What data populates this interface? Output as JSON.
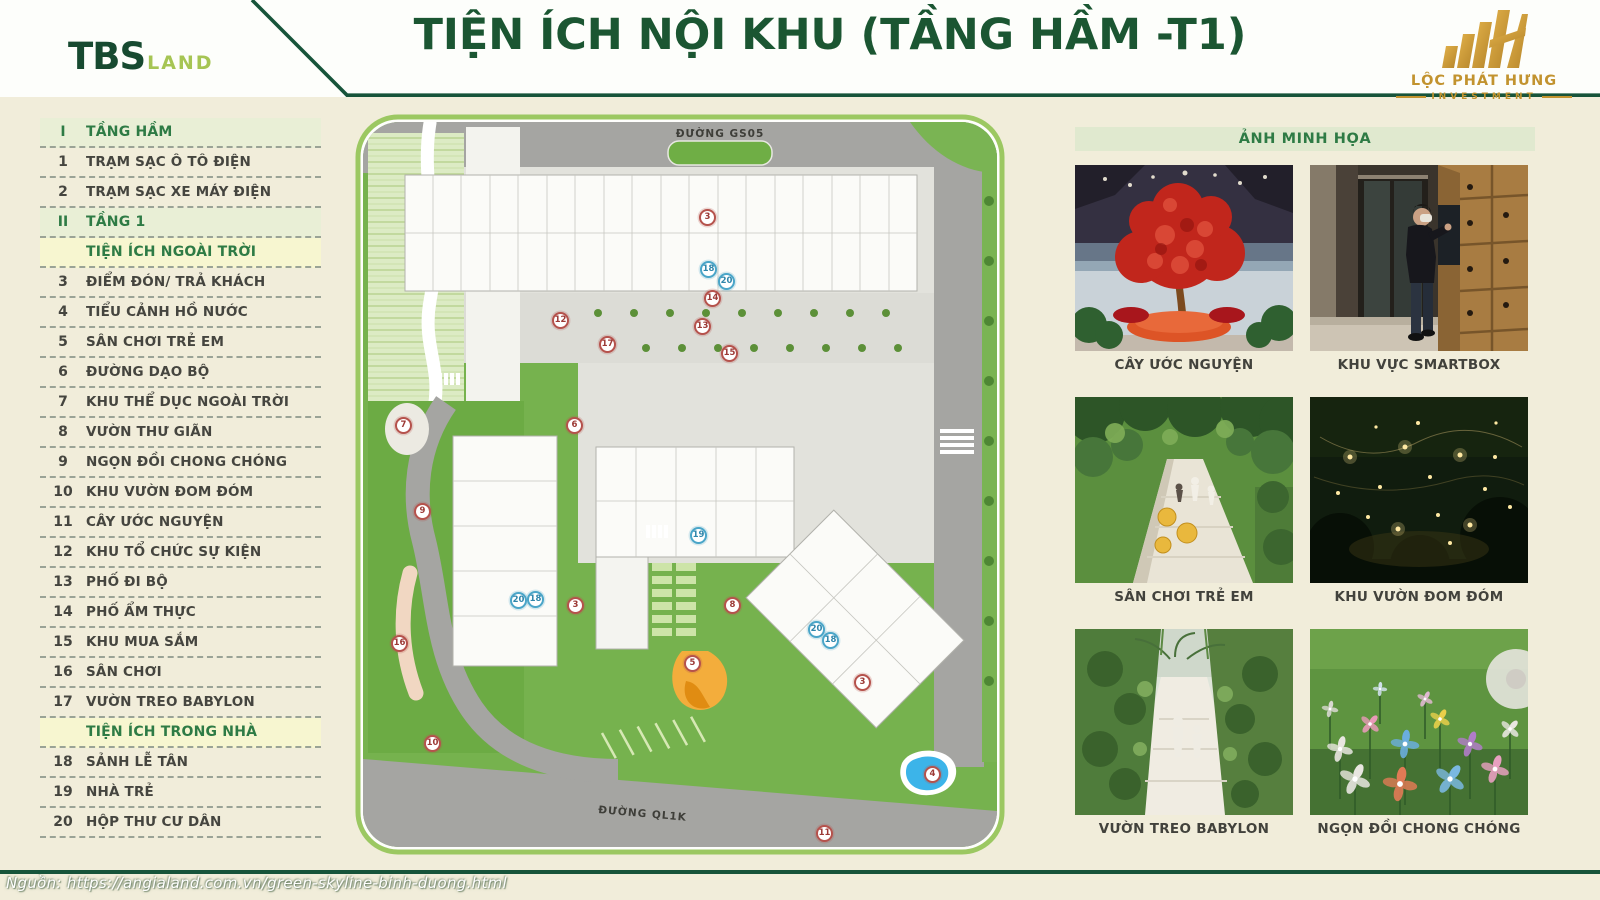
{
  "header": {
    "title": "TIỆN ÍCH NỘI KHU (TẦNG HẦM -T1)",
    "brand_left": {
      "name": "TBS",
      "suffix": "LAND"
    },
    "brand_right": {
      "name": "LỘC PHÁT HƯNG",
      "subtitle": "INVESTMENT"
    }
  },
  "sidebar": {
    "rows": [
      {
        "type": "section-green",
        "num": "I",
        "label": "TẦNG HẦM"
      },
      {
        "type": "item",
        "num": "1",
        "label": "TRẠM SẠC Ô TÔ ĐIỆN"
      },
      {
        "type": "item",
        "num": "2",
        "label": "TRẠM SẠC XE MÁY ĐIỆN"
      },
      {
        "type": "section-green",
        "num": "II",
        "label": "TẦNG 1"
      },
      {
        "type": "section-yellow",
        "num": "",
        "label": "TIỆN ÍCH NGOÀI TRỜI"
      },
      {
        "type": "item",
        "num": "3",
        "label": "ĐIỂM ĐÓN/ TRẢ KHÁCH"
      },
      {
        "type": "item",
        "num": "4",
        "label": "TIỂU CẢNH HỒ NƯỚC"
      },
      {
        "type": "item",
        "num": "5",
        "label": "SÂN CHƠI TRẺ EM"
      },
      {
        "type": "item",
        "num": "6",
        "label": "ĐƯỜNG DẠO BỘ"
      },
      {
        "type": "item",
        "num": "7",
        "label": "KHU THỂ DỤC NGOÀI TRỜI"
      },
      {
        "type": "item",
        "num": "8",
        "label": "VƯỜN THƯ GIÃN"
      },
      {
        "type": "item",
        "num": "9",
        "label": "NGỌN ĐỒI CHONG CHÓNG"
      },
      {
        "type": "item",
        "num": "10",
        "label": "KHU VƯỜN ĐOM ĐÓM"
      },
      {
        "type": "item",
        "num": "11",
        "label": "CÂY ƯỚC NGUYỆN"
      },
      {
        "type": "item",
        "num": "12",
        "label": "KHU TỔ CHỨC SỰ KIỆN"
      },
      {
        "type": "item",
        "num": "13",
        "label": "PHỐ ĐI BỘ"
      },
      {
        "type": "item",
        "num": "14",
        "label": "PHỐ ẨM THỰC"
      },
      {
        "type": "item",
        "num": "15",
        "label": "KHU MUA SẮM"
      },
      {
        "type": "item",
        "num": "16",
        "label": "SÂN CHƠI"
      },
      {
        "type": "item",
        "num": "17",
        "label": "VƯỜN TREO BABYLON"
      },
      {
        "type": "section-yellow",
        "num": "",
        "label": "TIỆN ÍCH TRONG NHÀ"
      },
      {
        "type": "item",
        "num": "18",
        "label": "SẢNH LỄ TÂN"
      },
      {
        "type": "item",
        "num": "19",
        "label": "NHÀ TRẺ"
      },
      {
        "type": "item",
        "num": "20",
        "label": "HỘP THƯ CƯ DÂN"
      }
    ]
  },
  "map": {
    "road_top_label": "ĐƯỜNG GS05",
    "road_bottom_label": "ĐƯỜNG QL1K",
    "markers": [
      {
        "n": "3",
        "x": 358,
        "y": 107,
        "color": "red"
      },
      {
        "n": "18",
        "x": 359,
        "y": 159,
        "color": "blue"
      },
      {
        "n": "20",
        "x": 377,
        "y": 171,
        "color": "blue"
      },
      {
        "n": "14",
        "x": 363,
        "y": 188,
        "color": "red"
      },
      {
        "n": "12",
        "x": 211,
        "y": 210,
        "color": "red"
      },
      {
        "n": "13",
        "x": 353,
        "y": 216,
        "color": "red"
      },
      {
        "n": "17",
        "x": 258,
        "y": 234,
        "color": "red"
      },
      {
        "n": "15",
        "x": 380,
        "y": 243,
        "color": "red"
      },
      {
        "n": "6",
        "x": 225,
        "y": 315,
        "color": "red"
      },
      {
        "n": "7",
        "x": 54,
        "y": 315,
        "color": "red"
      },
      {
        "n": "9",
        "x": 73,
        "y": 401,
        "color": "red"
      },
      {
        "n": "19",
        "x": 349,
        "y": 425,
        "color": "blue"
      },
      {
        "n": "20",
        "x": 169,
        "y": 490,
        "color": "blue"
      },
      {
        "n": "18",
        "x": 186,
        "y": 489,
        "color": "blue"
      },
      {
        "n": "3",
        "x": 226,
        "y": 495,
        "color": "red"
      },
      {
        "n": "8",
        "x": 383,
        "y": 495,
        "color": "red"
      },
      {
        "n": "20",
        "x": 467,
        "y": 519,
        "color": "blue"
      },
      {
        "n": "18",
        "x": 481,
        "y": 530,
        "color": "blue"
      },
      {
        "n": "16",
        "x": 50,
        "y": 533,
        "color": "red"
      },
      {
        "n": "5",
        "x": 343,
        "y": 553,
        "color": "red"
      },
      {
        "n": "3",
        "x": 513,
        "y": 572,
        "color": "red"
      },
      {
        "n": "10",
        "x": 83,
        "y": 633,
        "color": "red"
      },
      {
        "n": "4",
        "x": 583,
        "y": 664,
        "color": "red"
      },
      {
        "n": "11",
        "x": 475,
        "y": 723,
        "color": "red"
      }
    ]
  },
  "gallery": {
    "header": "ẢNH MINH HỌA",
    "photos": [
      {
        "caption": "CÂY ƯỚC NGUYỆN"
      },
      {
        "caption": "KHU VỰC SMARTBOX"
      },
      {
        "caption": "SÂN CHƠI TRẺ EM"
      },
      {
        "caption": "KHU VƯỜN ĐOM ĐÓM"
      },
      {
        "caption": "VƯỜN TREO BABYLON"
      },
      {
        "caption": "NGỌN ĐỒI CHONG CHÓNG"
      }
    ]
  },
  "footer": {
    "source": "Nguồn: https://angialand.com.vn/green-skyline-binh-duong.html"
  },
  "colors": {
    "dark_green": "#17543a",
    "title_green": "#1b5632",
    "lime": "#a6c554",
    "gold": "#c2932f",
    "cream_bg": "#f1edda",
    "marker_red": "#b5524c",
    "marker_blue": "#4aa5c8"
  }
}
